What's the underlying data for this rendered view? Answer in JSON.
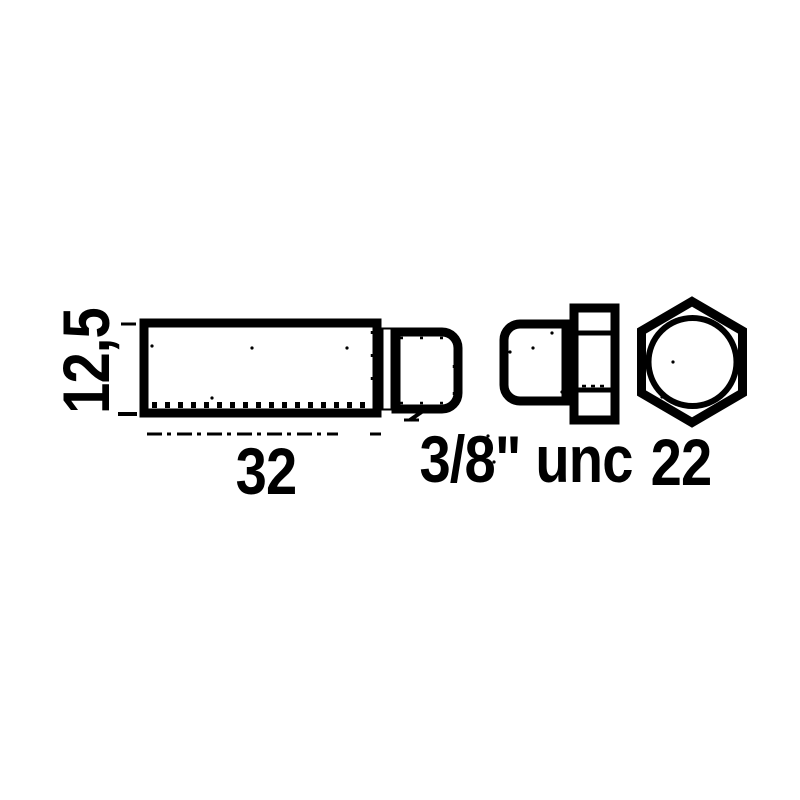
{
  "drawing": {
    "ink_color": "#000000",
    "paper_color": "#ffffff",
    "labels": {
      "diameter": "12,5",
      "length": "32",
      "thread": "3/8\" unc",
      "hex_across_flats": "22"
    }
  }
}
